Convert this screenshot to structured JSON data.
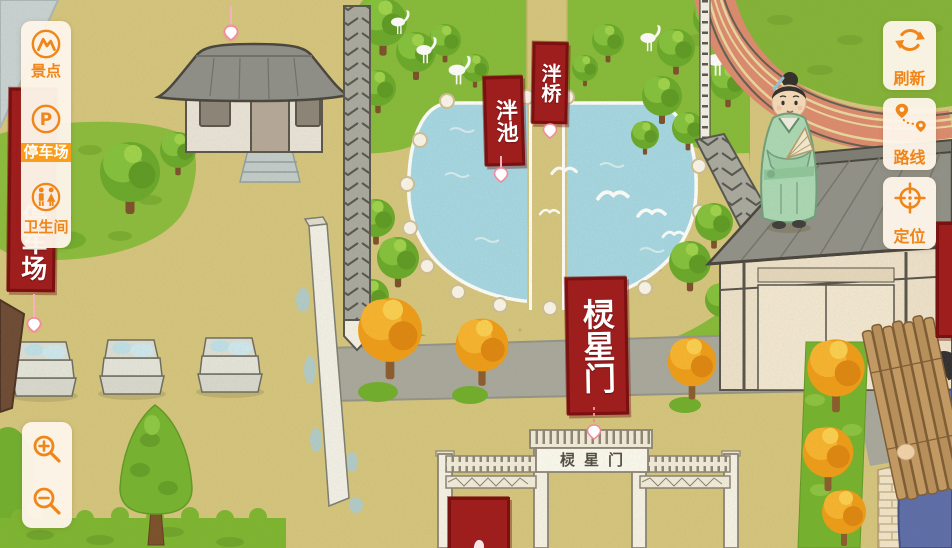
{
  "colors": {
    "accent": "#f08519",
    "selected_bg": "#f89e1c",
    "banner_red": "#9e1d1d",
    "panel_bg": "#fdf5ea",
    "pond_blue": "#a5d8e6",
    "grass_green": "#85bb38"
  },
  "sidebar": {
    "items": [
      {
        "id": "scenic-spots",
        "label": "景点",
        "icon": "scenic-spots-icon",
        "selected": false
      },
      {
        "id": "parking",
        "label": "停车场",
        "icon": "parking-icon",
        "selected": true
      },
      {
        "id": "restroom",
        "label": "卫生间",
        "icon": "restroom-icon",
        "selected": false
      }
    ]
  },
  "zoom_controls": {
    "zoom_in_icon": "zoom-in-magnifier-icon",
    "zoom_out_icon": "zoom-out-magnifier-icon"
  },
  "action_buttons": [
    {
      "id": "refresh",
      "label": "刷新",
      "icon": "refresh-icon"
    },
    {
      "id": "route",
      "label": "路线",
      "icon": "route-icon"
    },
    {
      "id": "locate",
      "label": "定位",
      "icon": "locate-icon"
    }
  ],
  "map": {
    "banners": {
      "parking": "停车场",
      "panchi": "泮池",
      "panqiao": "泮桥",
      "lingxingmen": "棂星门"
    },
    "gate_plaque": "棂星门"
  }
}
